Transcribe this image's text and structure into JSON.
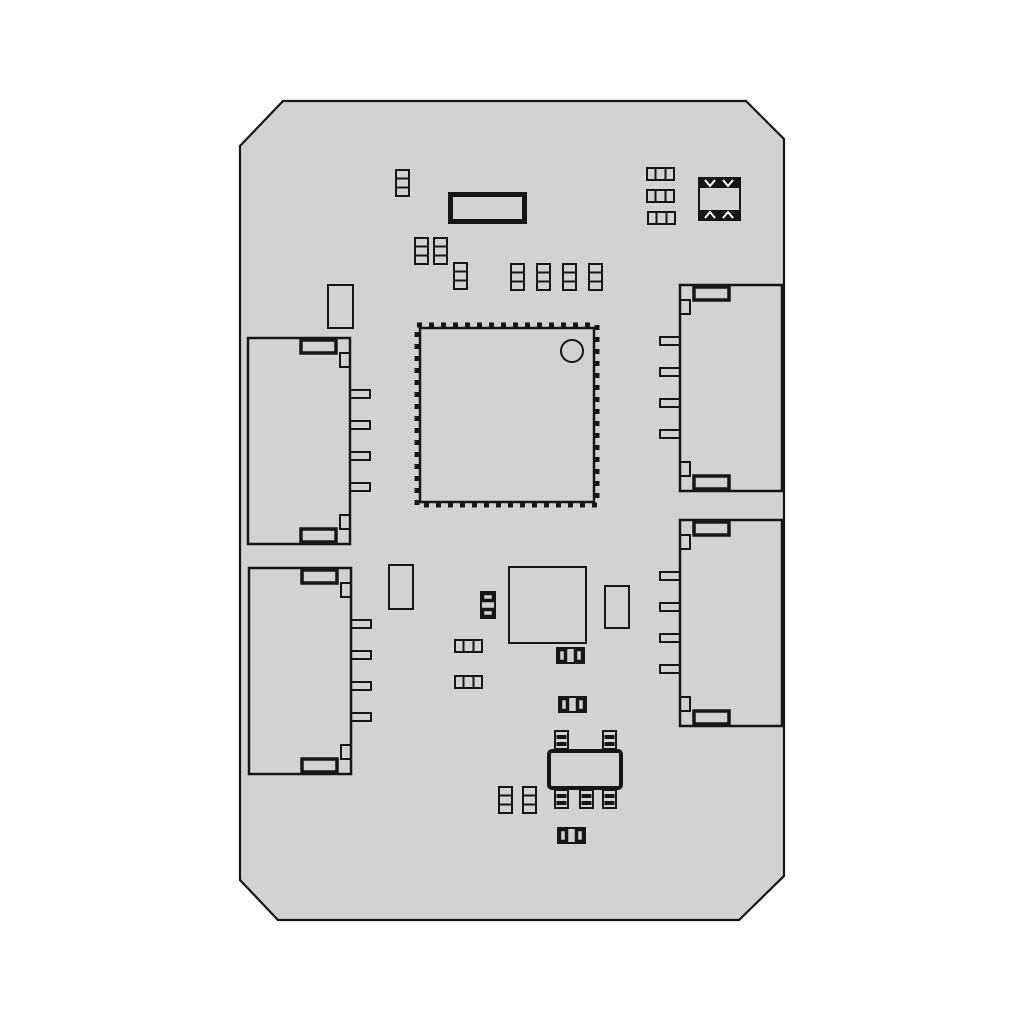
{
  "page": {
    "background": "#ffffff",
    "description": "Monochrome technical line drawing of a PCB module, top assembly view, on a light gray octagonal board with chamfered corners"
  },
  "board": {
    "fill": "#d2d2d2",
    "line_color": "#161616",
    "outline_points": "283,101 746,101 784,139 784,876 739,920 278,920 240,880 240,146"
  },
  "components": {
    "connector_count": 4,
    "connector_type": "smd-side-entry-header-4pin",
    "main_ic": "qfn-package-with-dashed-pin-fringe-and-pin1-dot",
    "oscillator": "thick-border-rectangular-module",
    "crystal": "4-pad-crystal-resonator-with-notched-pads",
    "regulator": "sot23-5-package-5pin",
    "square_ic": "plain-square-outline-ic",
    "passive_count": 18,
    "small_outline_rect_count": 3
  }
}
